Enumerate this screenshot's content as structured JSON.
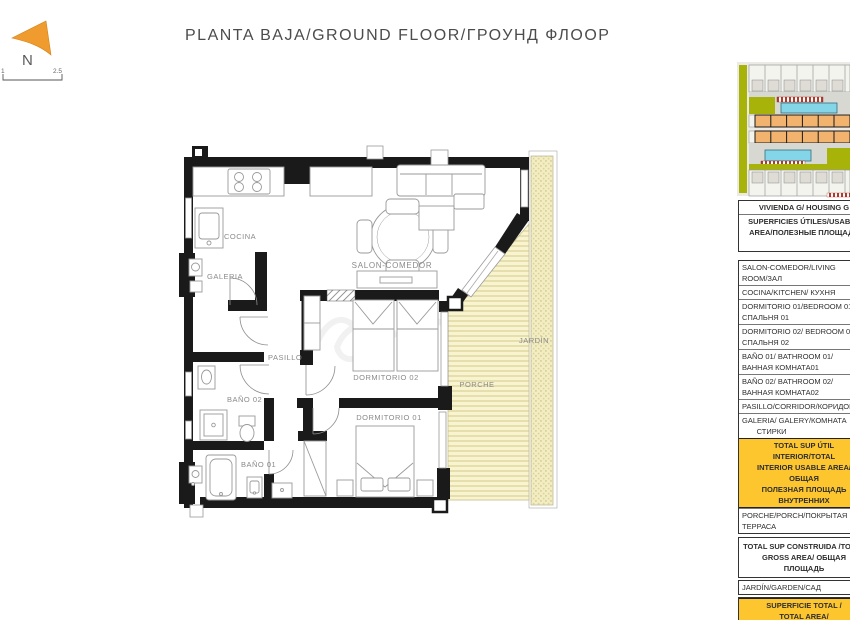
{
  "title": "PLANTA BAJA/GROUND FLOOR/ГРОУНД ФЛООР",
  "compass": {
    "label": "N"
  },
  "scale_bar": {
    "left_label": "1",
    "right_label": "2.5"
  },
  "floor_plan": {
    "rooms": {
      "cocina": "COCINA",
      "galeria": "GALERIA",
      "salon": "SALON-COMEDOR",
      "pasillo": "PASILLO",
      "dormitorio2": "DORMITORIO 02",
      "dormitorio1": "DORMITORIO 01",
      "bano2": "BAÑO 02",
      "bano1": "BAÑO 01",
      "jardin": "JARDÍN",
      "porche": "PORCHE"
    }
  },
  "area_table": {
    "header": "VIVIENDA G/ HOUSING G",
    "subheader": "SUPERFICIES ÚTILES/USABLE\nAREA/ПОЛЕЗНЫЕ ПЛОЩАДИ",
    "rows": [
      "SALON-COMEDOR/LIVING\nROOM/ЗАЛ",
      "COCINA/KITCHEN/ КУХНЯ",
      "DORMITORIO 01/BEDROOM 01/\nСПАЛЬНЯ 01",
      "DORMITORIO 02/ BEDROOM 02/\nСПАЛЬНЯ 02",
      "BAÑO 01/ BATHROOM 01/\nВАННАЯ КОМНАТА01",
      "BAÑO 02/ BATHROOM 02/\nВАННАЯ КОМНАТА02",
      "PASILLO/CORRIDOR/КОРИДОР",
      "GALERIA/ GALERY/КОМНАТА\n       СТИРКИ"
    ],
    "total_interior": "TOTAL SUP ÚTIL INTERIOR/TOTAL\nINTERIOR USABLE AREA/ ОБЩАЯ\nПОЛЕЗНАЯ ПЛОЩАДЬ\nВНУТРЕННИХ",
    "porch_row": "PORCHE/PORCH/ПОКРЫТАЯ\nТЕРРАСА",
    "total_built": "TOTAL SUP CONSTRUIDA /TOTAL\nGROSS AREA/ ОБЩАЯ ПЛОЩАДЬ",
    "garden_row": "JARDÍN/GARDEN/САД",
    "total_area": "SUPERFICIE TOTAL /\nTOTAL AREA/\nОБЩАЯ ПЛОЩАДЬ БРУТТО"
  },
  "colors": {
    "accent_yellow": "#fdc62f",
    "porch_fill": "#f8f4d0",
    "garden_fill": "#f3edc3",
    "wall": "#1a1a1a",
    "compass_orange": "#ef9b2d",
    "siteplan_olive": "#a7b309",
    "siteplan_orange": "#f1b36d",
    "siteplan_pool": "#84d5e8",
    "siteplan_red": "#b33a2c"
  }
}
